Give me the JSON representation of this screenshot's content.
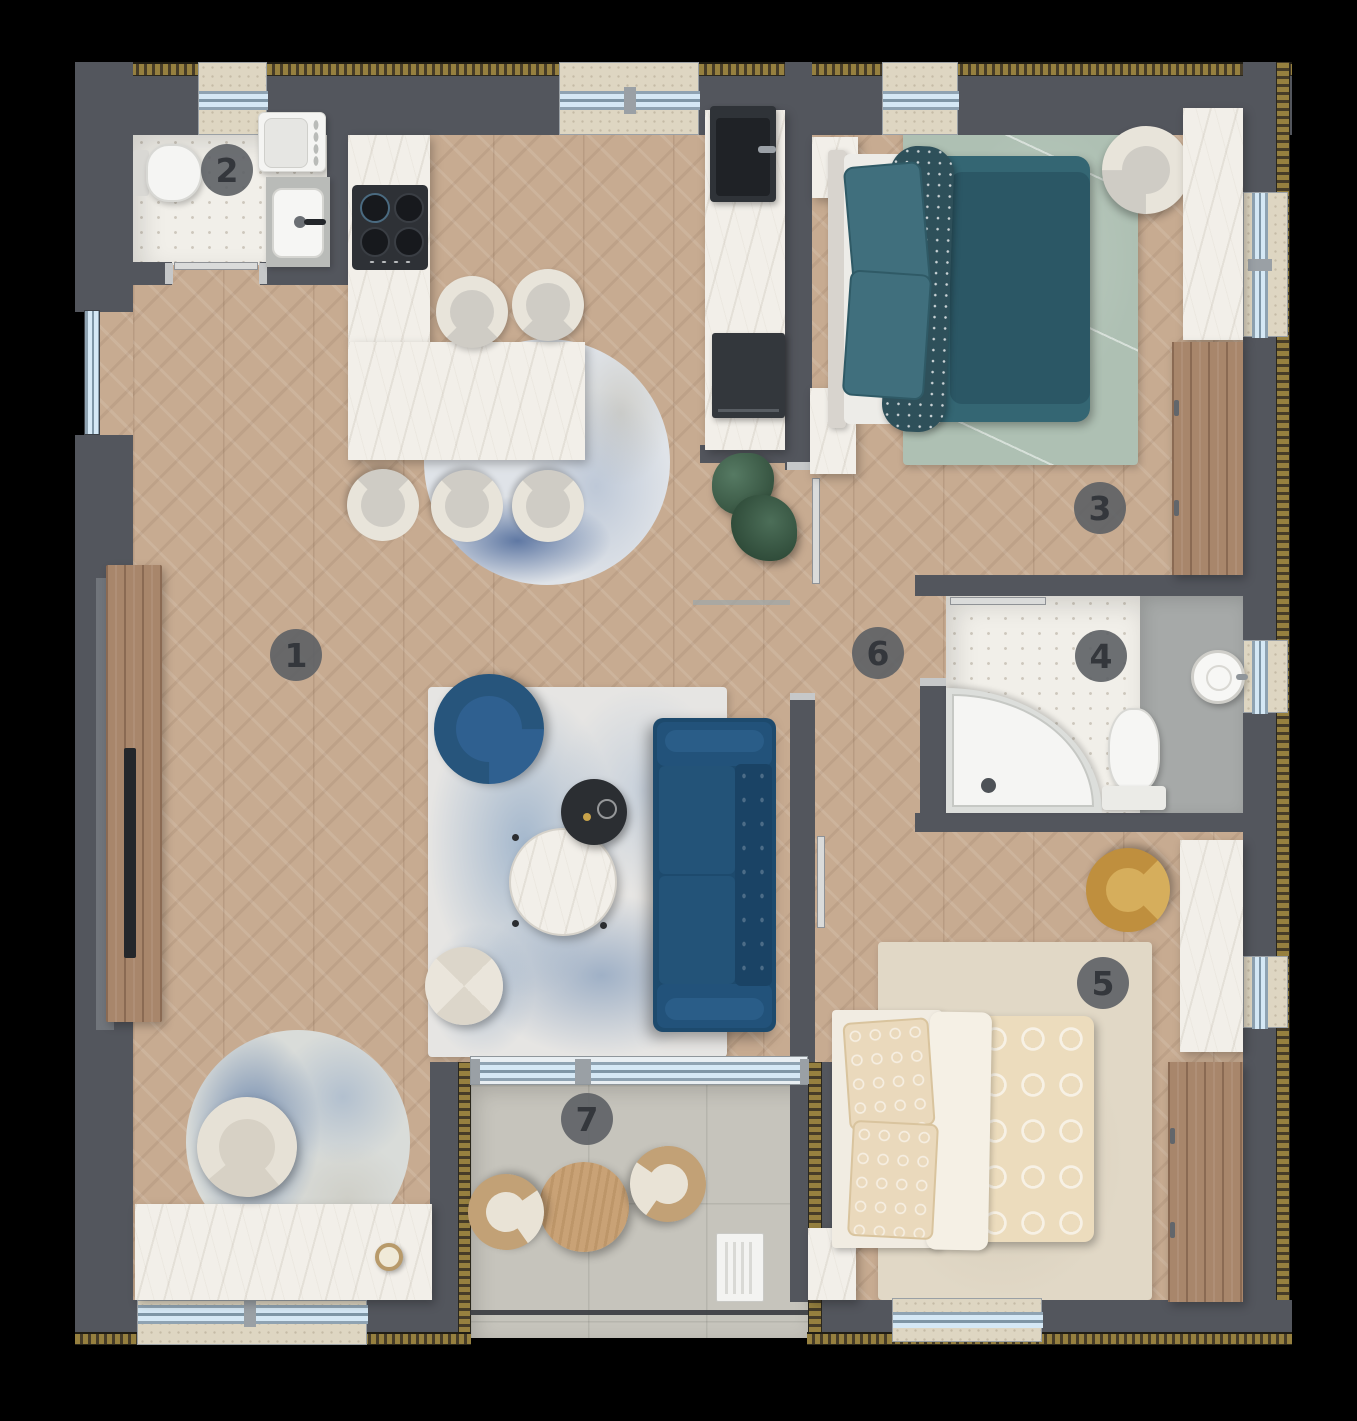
{
  "scene": {
    "description": "Top-down 3D rendered apartment floor plan with numbered rooms",
    "background": "#000000"
  },
  "rooms": [
    {
      "number": "1",
      "name": "living-room-open-kitchen"
    },
    {
      "number": "2",
      "name": "bathroom-laundry"
    },
    {
      "number": "3",
      "name": "bedroom-teal"
    },
    {
      "number": "4",
      "name": "bathroom-shower"
    },
    {
      "number": "5",
      "name": "bedroom-beige"
    },
    {
      "number": "6",
      "name": "hallway"
    },
    {
      "number": "7",
      "name": "balcony"
    }
  ],
  "palette": {
    "wall": "#53565d",
    "insulation_hatch": "#96803f",
    "wood_floor": "#c7ab91",
    "wood_furniture": "#a8866b",
    "marble": "#f2efe9",
    "hex_tile": "#f1efe9",
    "gray_tile": "#a6a9a8",
    "balcony_stone": "#c6c4bc",
    "window_glass": "#d5e8f5",
    "window_sill": "#ded6c2",
    "sofa_navy": "#1d4a6d",
    "armchair_blue": "#27557c",
    "bed_teal": "#346673",
    "blanket_teal": "#2b5765",
    "rug_sage": "#aec0b3",
    "rug_beige": "#e1d8c6",
    "bed_beige": "#ecdcbd",
    "armchair_mustard": "#bf8f3e",
    "cream_upholstery": "#e8e4da",
    "rug_blue_accent": "#6f93bb",
    "appliance_dark": "#2f3338",
    "plant_green": "#3f5e4b",
    "badge_background": "#5d6065",
    "badge_text": "#34373c"
  },
  "furniture": {
    "living_room_1": [
      "tv-console",
      "tv",
      "navy-sofa",
      "blue-armchair",
      "marble-coffee-table",
      "black-side-table",
      "pouf",
      "abstract-blue-rug",
      "cream-armchair",
      "round-blue-rug",
      "marble-console",
      "candle"
    ],
    "kitchen_area_1": [
      "marble-counter",
      "gas-hob",
      "marble-island-table",
      "shell-chairs-x5",
      "dark-sink",
      "built-in-oven",
      "round-rug",
      "monstera-plant"
    ],
    "bathroom_2": [
      "toilet",
      "washing-machine",
      "sink-counter"
    ],
    "bedroom_3": [
      "double-bed-teal",
      "sage-rug",
      "cream-armchair",
      "wood-wardrobe",
      "marble-nightstands",
      "marble-dresser"
    ],
    "bathroom_4": [
      "corner-shower",
      "toilet",
      "round-washbasin"
    ],
    "bedroom_5": [
      "double-bed-beige",
      "beige-rug",
      "mustard-armchair",
      "wood-wardrobe",
      "marble-dresser",
      "marble-corner-unit"
    ],
    "hallway_6": [
      "threshold"
    ],
    "balcony_7": [
      "round-wood-table",
      "rattan-chairs-x2",
      "ac-unit",
      "glass-railing"
    ]
  }
}
